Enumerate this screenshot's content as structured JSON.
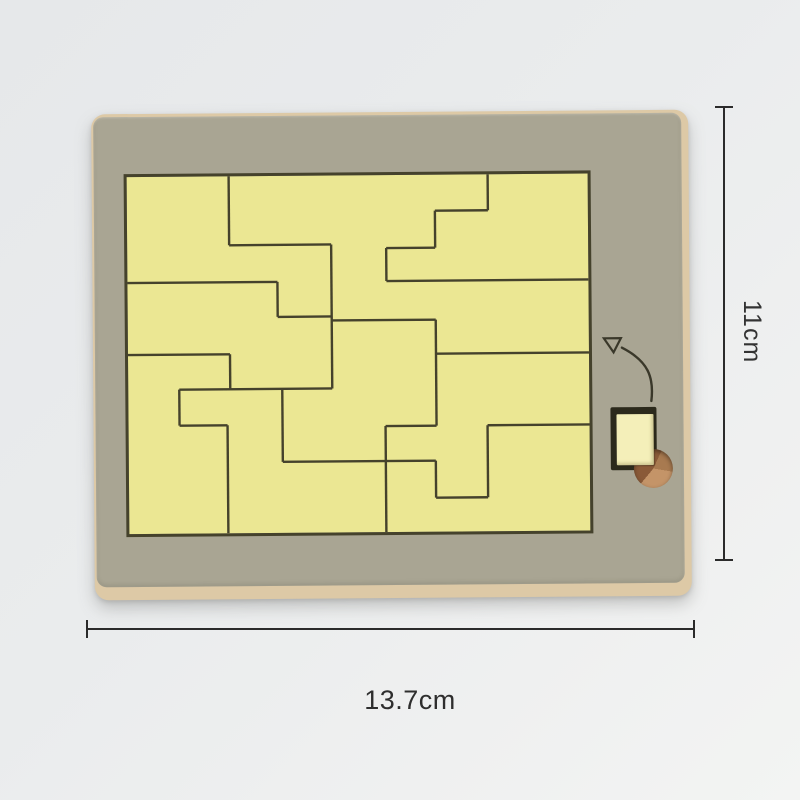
{
  "annotations": {
    "height_label": "11cm",
    "width_label": "13.7cm"
  },
  "board": {
    "description": "wooden slide-in tetromino puzzle board",
    "piece_count": 9,
    "colors": {
      "frame": "#a9a593",
      "edge": "#ddc9a6",
      "puzzle_bg": "#ebe793",
      "cut_line": "#45422c",
      "slot_piece": "#f4efb9",
      "hole_wood": [
        "#8a5a38",
        "#c49468",
        "#a87a50"
      ],
      "dimension": "#2b2b2b"
    },
    "puzzle_cut_segments": [
      [
        102,
        0,
        102,
        69
      ],
      [
        204,
        69,
        204,
        213
      ],
      [
        150,
        106,
        150,
        141
      ],
      [
        361,
        0,
        361,
        36
      ],
      [
        308,
        36,
        308,
        73
      ],
      [
        259,
        73,
        259,
        106
      ],
      [
        308,
        145,
        308,
        251
      ],
      [
        102,
        178,
        102,
        213
      ],
      [
        51,
        213,
        51,
        249
      ],
      [
        99,
        249,
        99,
        357
      ],
      [
        154,
        213,
        154,
        286
      ],
      [
        257,
        251,
        257,
        357
      ],
      [
        359,
        251,
        359,
        323
      ],
      [
        307,
        286,
        307,
        323
      ],
      [
        102,
        69,
        204,
        69
      ],
      [
        150,
        141,
        204,
        141
      ],
      [
        204,
        145,
        308,
        145
      ],
      [
        0,
        106,
        150,
        106
      ],
      [
        308,
        36,
        361,
        36
      ],
      [
        259,
        73,
        308,
        73
      ],
      [
        259,
        106,
        461,
        106
      ],
      [
        308,
        179,
        461,
        179
      ],
      [
        0,
        178,
        102,
        178
      ],
      [
        51,
        213,
        204,
        213
      ],
      [
        51,
        249,
        99,
        249
      ],
      [
        154,
        286,
        307,
        286
      ],
      [
        257,
        251,
        308,
        251
      ],
      [
        359,
        251,
        461,
        251
      ],
      [
        307,
        323,
        359,
        323
      ]
    ],
    "arrow_icon": "curved-insert-arrow"
  }
}
